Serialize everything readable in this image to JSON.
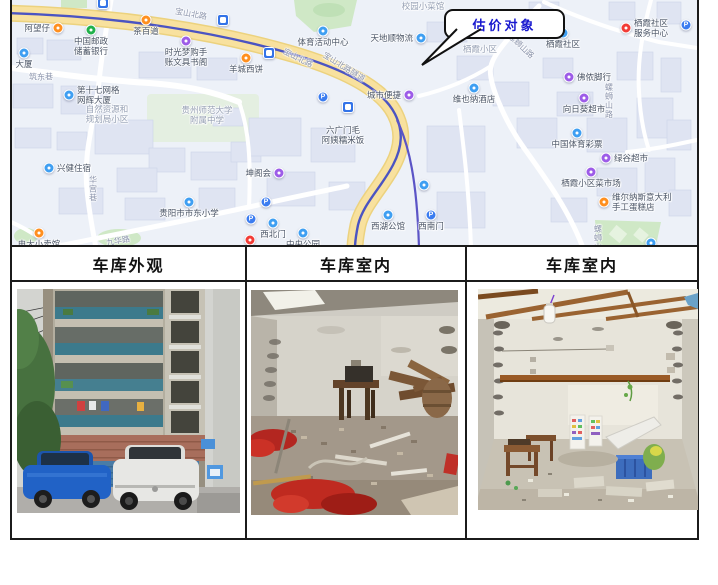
{
  "page": {
    "background": "#ffffff"
  },
  "callout": {
    "label": "估价对象",
    "text_color": "#1818cf"
  },
  "table": {
    "headers": [
      "车库外观",
      "车库室内",
      "车库室内"
    ]
  },
  "photos": [
    {
      "name": "garage-exterior"
    },
    {
      "name": "garage-interior-1"
    },
    {
      "name": "garage-interior-2"
    }
  ],
  "map": {
    "colors": {
      "orange": "#ff8f1f",
      "green": "#21b14b",
      "blue": "#3f9ff2",
      "purple": "#9d5ce8",
      "red": "#f23c36",
      "metro_line": "#4b54c2",
      "road_fill": "#f8e19e",
      "park": "#cfe8c6"
    },
    "pois": [
      {
        "x": 47,
        "y": 28,
        "type": "dot",
        "color": "orange",
        "side": "left",
        "label_lines": [
          "阿望仔"
        ]
      },
      {
        "x": 80,
        "y": 30,
        "type": "dot",
        "color": "green",
        "side": "below",
        "label_lines": [
          "中国邮政",
          "储蓄银行"
        ]
      },
      {
        "x": 135,
        "y": 20,
        "type": "dot",
        "color": "orange",
        "side": "below",
        "label_lines": [
          "茶百道"
        ]
      },
      {
        "x": 175,
        "y": 41,
        "type": "dot",
        "color": "purple",
        "side": "below",
        "label_lines": [
          "时光梦购手",
          "账文具书阁"
        ]
      },
      {
        "x": 235,
        "y": 58,
        "type": "dot",
        "color": "orange",
        "side": "below",
        "label_lines": [
          "羊城西饼"
        ]
      },
      {
        "x": 312,
        "y": 31,
        "type": "dot",
        "color": "blue",
        "side": "below",
        "label_lines": [
          "体育活动中心"
        ]
      },
      {
        "x": 410,
        "y": 38,
        "type": "dot",
        "color": "blue",
        "side": "left",
        "label_lines": [
          "天地顺物流"
        ]
      },
      {
        "x": 412,
        "y": 6,
        "type": "label",
        "muted": true,
        "side": "center",
        "label_lines": [
          "校园小菜馆"
        ]
      },
      {
        "x": 469,
        "y": 49,
        "type": "label",
        "muted": true,
        "side": "center",
        "label_lines": [
          "栖霞小区"
        ]
      },
      {
        "x": 552,
        "y": 33,
        "type": "dot",
        "color": "blue",
        "side": "below",
        "label_lines": [
          "栖霞社区"
        ]
      },
      {
        "x": 615,
        "y": 28,
        "type": "dot",
        "color": "red",
        "side": "right",
        "label_lines": [
          "栖霞社区",
          "服务中心"
        ]
      },
      {
        "x": 675,
        "y": 25,
        "type": "p",
        "label_lines": []
      },
      {
        "x": 558,
        "y": 77,
        "type": "dot",
        "color": "purple",
        "side": "right",
        "label_lines": [
          "佛侬脚行"
        ]
      },
      {
        "x": 573,
        "y": 98,
        "type": "dot",
        "color": "purple",
        "side": "below",
        "label_lines": [
          "向日葵超市"
        ]
      },
      {
        "x": 463,
        "y": 88,
        "type": "dot",
        "color": "blue",
        "side": "below",
        "label_lines": [
          "维也纳酒店"
        ]
      },
      {
        "x": 398,
        "y": 95,
        "type": "dot",
        "color": "purple",
        "side": "left",
        "label_lines": [
          "城市便捷"
        ]
      },
      {
        "x": 566,
        "y": 133,
        "type": "dot",
        "color": "blue",
        "side": "below",
        "label_lines": [
          "中国体育彩票"
        ]
      },
      {
        "x": 595,
        "y": 158,
        "type": "dot",
        "color": "purple",
        "side": "right",
        "label_lines": [
          "绿谷超市"
        ]
      },
      {
        "x": 580,
        "y": 172,
        "type": "dot",
        "color": "purple",
        "side": "below",
        "label_lines": [
          "栖霞小区菜市场"
        ]
      },
      {
        "x": 593,
        "y": 202,
        "type": "dot",
        "color": "orange",
        "side": "right",
        "label_lines": [
          "维尔纳斯意大利",
          "手工蛋糕店"
        ]
      },
      {
        "x": 332,
        "y": 135,
        "type": "label",
        "side": "center",
        "label_lines": [
          "六广门毛",
          "阿姨糯米饭"
        ]
      },
      {
        "x": 268,
        "y": 173,
        "type": "dot",
        "color": "purple",
        "side": "left",
        "label_lines": [
          "坤阁会"
        ]
      },
      {
        "x": 255,
        "y": 202,
        "type": "p",
        "label_lines": []
      },
      {
        "x": 262,
        "y": 223,
        "type": "dot",
        "color": "blue",
        "side": "below",
        "label_lines": [
          "西北门"
        ]
      },
      {
        "x": 292,
        "y": 233,
        "type": "dot",
        "color": "blue",
        "side": "below",
        "label_lines": [
          "中央公园"
        ]
      },
      {
        "x": 377,
        "y": 215,
        "type": "dot",
        "color": "blue",
        "side": "below",
        "label_lines": [
          "西湖公馆"
        ]
      },
      {
        "x": 420,
        "y": 215,
        "type": "p",
        "side": "below",
        "label_lines": [
          "西南门"
        ]
      },
      {
        "x": 38,
        "y": 168,
        "type": "dot",
        "color": "blue",
        "side": "right",
        "label_lines": [
          "兴健住宿"
        ]
      },
      {
        "x": 178,
        "y": 202,
        "type": "dot",
        "color": "blue",
        "side": "below",
        "label_lines": [
          "贵阳市市东小学"
        ]
      },
      {
        "x": 28,
        "y": 233,
        "type": "dot",
        "color": "orange",
        "side": "below",
        "label_lines": [
          "电大小卖馆"
        ]
      },
      {
        "x": 58,
        "y": 95,
        "type": "dot",
        "color": "blue",
        "side": "right",
        "label_lines": [
          "第十七网格",
          "网辉大厦"
        ]
      },
      {
        "x": 240,
        "y": 219,
        "type": "p",
        "label_lines": []
      },
      {
        "x": 239,
        "y": 240,
        "type": "dot",
        "color": "red",
        "label_lines": []
      },
      {
        "x": 13,
        "y": 53,
        "type": "dot",
        "color": "blue",
        "side": "below",
        "label_lines": [
          "大厦"
        ]
      },
      {
        "x": 212,
        "y": 20,
        "type": "metro",
        "label_lines": []
      },
      {
        "x": 258,
        "y": 53,
        "type": "metro",
        "label_lines": []
      },
      {
        "x": 337,
        "y": 107,
        "type": "metro",
        "label_lines": []
      },
      {
        "x": 92,
        "y": 3,
        "type": "metro",
        "label_lines": []
      },
      {
        "x": 312,
        "y": 97,
        "type": "p",
        "label_lines": []
      },
      {
        "x": 413,
        "y": 185,
        "type": "dot",
        "color": "blue",
        "label_lines": []
      },
      {
        "x": 640,
        "y": 243,
        "type": "dot",
        "color": "blue",
        "label_lines": []
      },
      {
        "x": 96,
        "y": 114,
        "type": "label",
        "muted": true,
        "side": "center",
        "label_lines": [
          "自然资源和",
          "规划局小区"
        ]
      },
      {
        "x": 196,
        "y": 115,
        "type": "label",
        "muted": true,
        "side": "center",
        "label_lines": [
          "贵州师范大学",
          "附属中学"
        ]
      }
    ],
    "road_labels": [
      {
        "text": "宝山北路",
        "x": 180,
        "y": 14,
        "rot": 10
      },
      {
        "text": "宝山北路",
        "x": 287,
        "y": 58,
        "rot": 27
      },
      {
        "text": "宝山北路隧道",
        "x": 333,
        "y": 67,
        "rot": 32
      },
      {
        "text": "筑东巷",
        "x": 30,
        "y": 77,
        "rot": 0
      },
      {
        "text": "九华路",
        "x": 107,
        "y": 241,
        "rot": -10
      },
      {
        "text": "螺蛳山路",
        "x": 510,
        "y": 46,
        "rot": 43
      },
      {
        "text": "螺蛳山路",
        "x": 598,
        "y": 101,
        "vertical": true
      },
      {
        "text": "螺蛳山",
        "x": 587,
        "y": 238,
        "vertical": true
      },
      {
        "text": "华宫巷",
        "x": 82,
        "y": 189,
        "vertical": true
      }
    ]
  }
}
